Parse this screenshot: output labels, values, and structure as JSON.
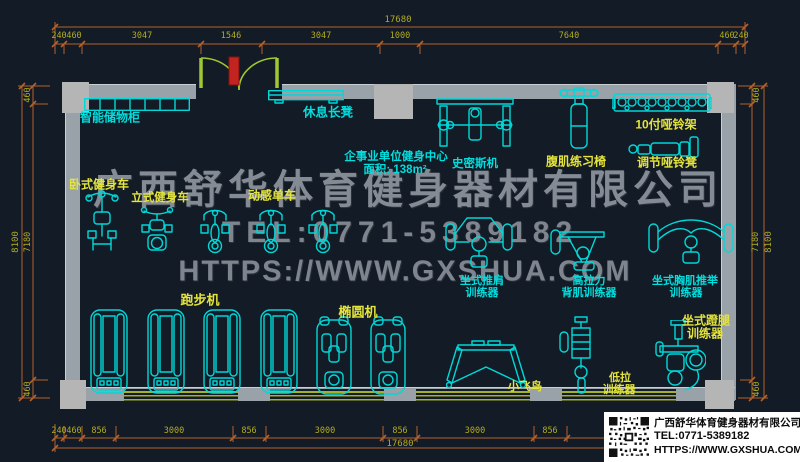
{
  "drawing": {
    "room": {
      "title": "企事业单位健身中心",
      "area": "面积: 138m²"
    },
    "equipment_labels": {
      "lockers": "智能储物柜",
      "rest_bench": "休息长凳",
      "smith_machine": "史密斯机",
      "ab_chair": "腹肌练习椅",
      "dumbbell_rack": "10付哑铃架",
      "dumbbell_bench": "调节哑铃凳",
      "recumbent_bike": "卧式健身车",
      "upright_bike": "立式健身车",
      "spin_bike": "动感单车",
      "shoulder_press_line1": "坐式推肩",
      "shoulder_press_line2": "训练器",
      "lat_pull_line1": "高拉力",
      "lat_pull_line2": "背肌训练器",
      "chest_press_line1": "坐式胸肌推举",
      "chest_press_line2": "训练器",
      "treadmill": "跑步机",
      "elliptical": "椭圆机",
      "cable_fly": "小飞鸟",
      "low_row_line1": "低拉",
      "low_row_line2": "训练器",
      "leg_press_line1": "坐式蹬腿",
      "leg_press_line2": "训练器"
    },
    "dimensions": {
      "top": {
        "total": "17680",
        "segments": [
          "240",
          "460",
          "3047",
          "1546",
          "3047",
          "1000",
          "7640",
          "460",
          "240"
        ]
      },
      "bottom": {
        "total": "17680",
        "segments": [
          "240",
          "460",
          "856",
          "3000",
          "856",
          "3000",
          "856",
          "3000",
          "856"
        ]
      },
      "left": {
        "overall": "8100",
        "segments": [
          "460",
          "7180",
          "460"
        ]
      },
      "right": {
        "overall": "8100",
        "segments": [
          "460",
          "7180",
          "460"
        ]
      }
    }
  },
  "watermark": {
    "company": "广西舒华体育健身器材有限公司",
    "tel": "TEL:0771-5389182",
    "url": "HTTPS://WWW.GXSHUA.COM"
  },
  "logo_card": {
    "company": "广西舒华体育健身器材有限公司",
    "tel": "TEL:0771-5389182",
    "url": "HTTPS://WWW.GXSHUA.COM"
  },
  "colors": {
    "background": "#131b26",
    "equipment_cyan": "#00d8d8",
    "label_cyan": "#00dede",
    "label_yellow": "#e4e43c",
    "dimension_line": "#b4622a",
    "dimension_text": "#b2ac20",
    "wall_gray": "#99a1a9",
    "column_gray": "#b5b5b5",
    "door_green": "#a0c832",
    "window_green": "#a4b22a",
    "watermark_gray": "#7e858e"
  }
}
